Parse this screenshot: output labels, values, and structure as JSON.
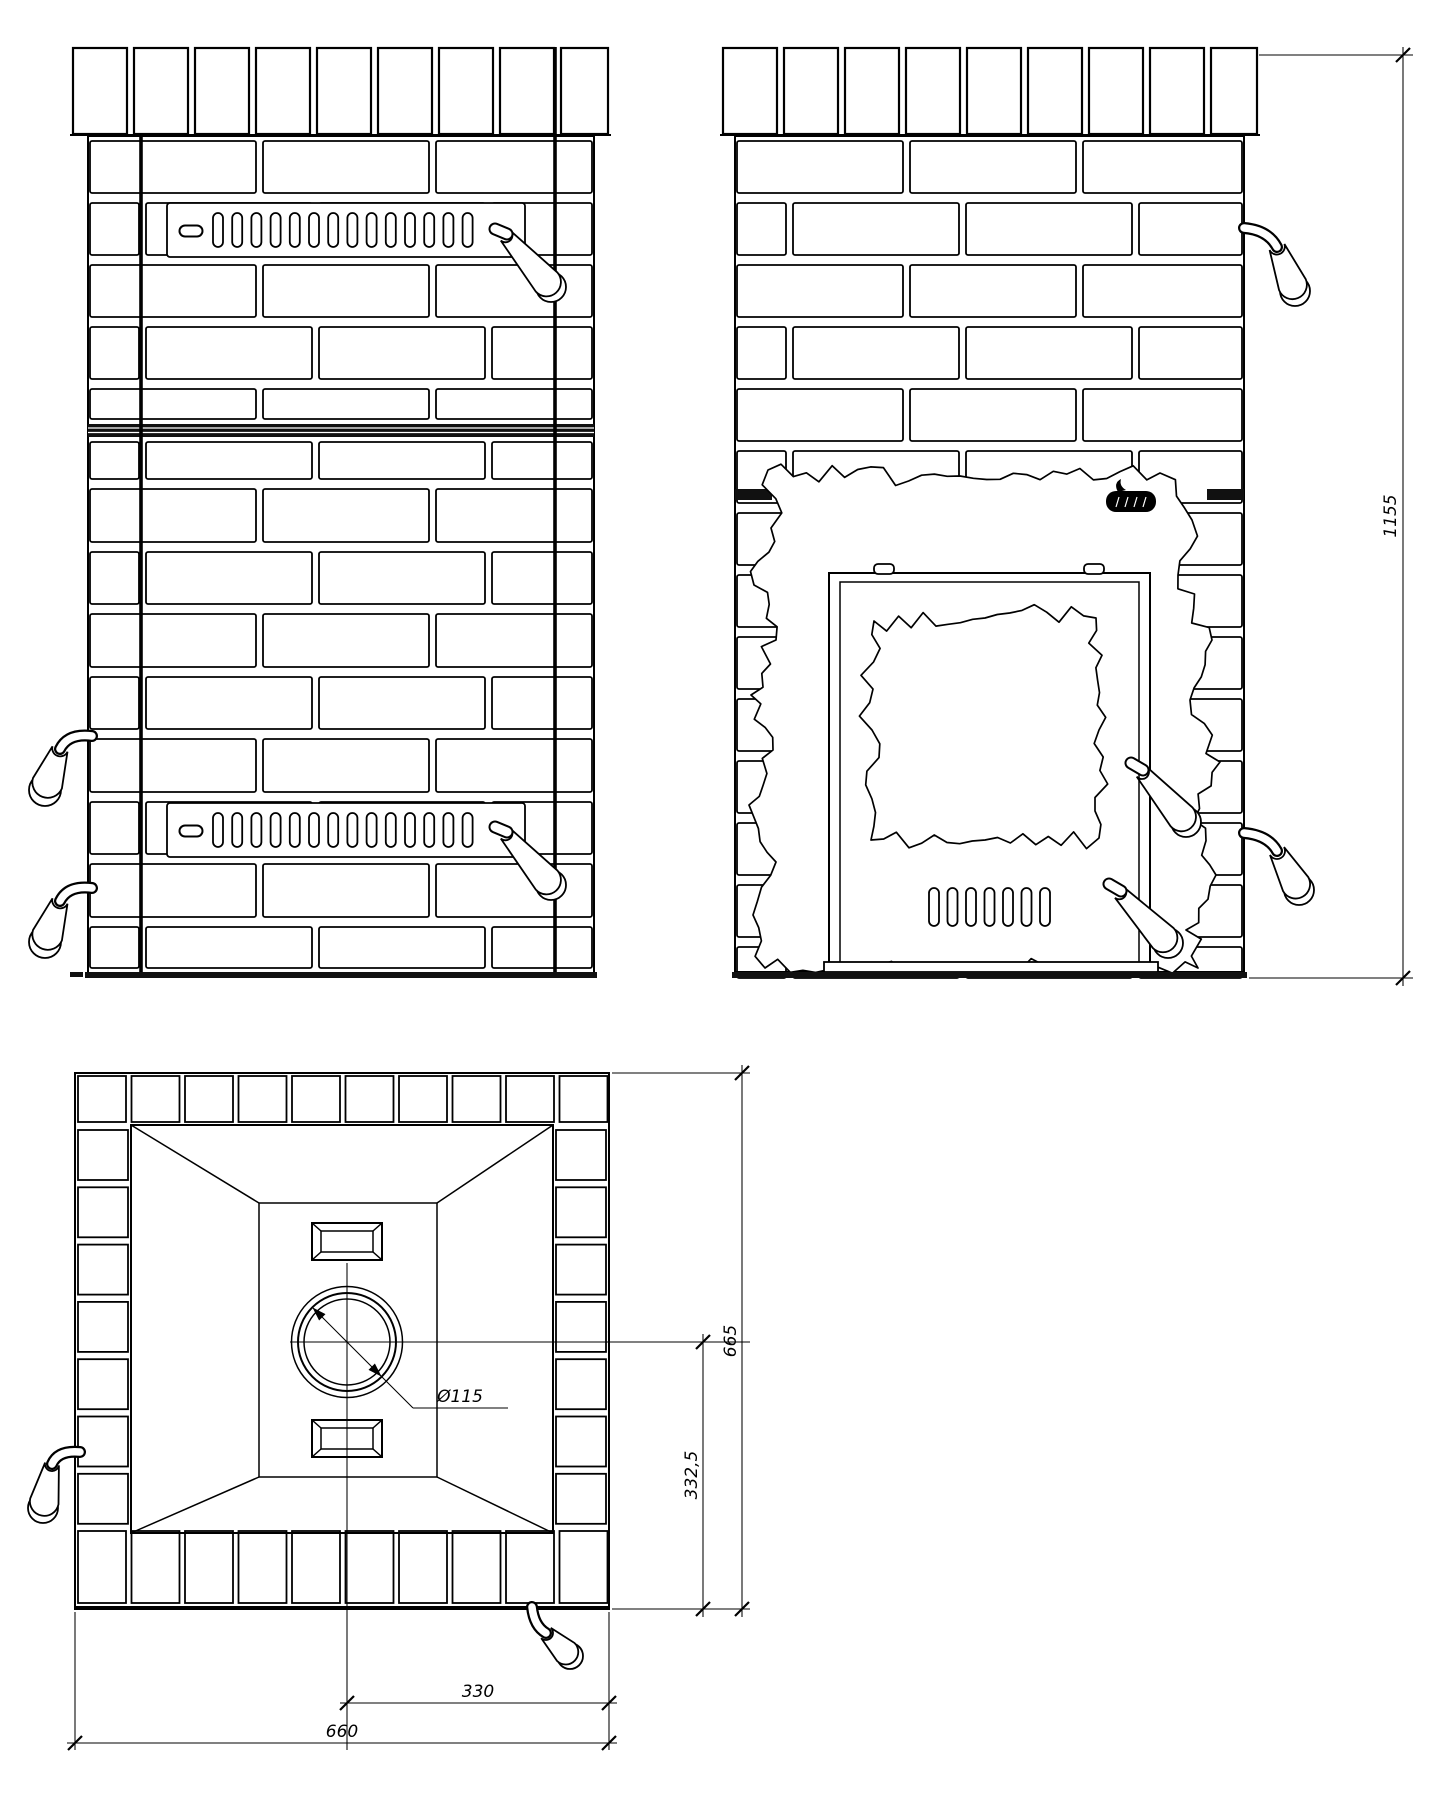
{
  "drawing": {
    "type": "technical drawing",
    "subject": "brick-clad sauna stove, three orthographic views with masonry cutaway",
    "line_color": "#000000",
    "background_color": "#ffffff"
  },
  "views": {
    "grille_side": {
      "vent_grilles": 2,
      "vent_slots_per_grille": 14,
      "side_handles": 2
    },
    "door_side": {
      "door_air_slots": 7,
      "door_handles": 2,
      "side_handles": 2,
      "brand_logo_present": true
    },
    "top": {
      "steam_vents": 2,
      "chimney_rings": 3,
      "handles": 2
    }
  },
  "dimensions": {
    "overall_height": "1155",
    "overall_depth": "665",
    "chimney_axis_to_rear": "332,5",
    "chimney_axis_to_side": "330",
    "overall_width": "660",
    "chimney_diameter": "Ø115"
  }
}
